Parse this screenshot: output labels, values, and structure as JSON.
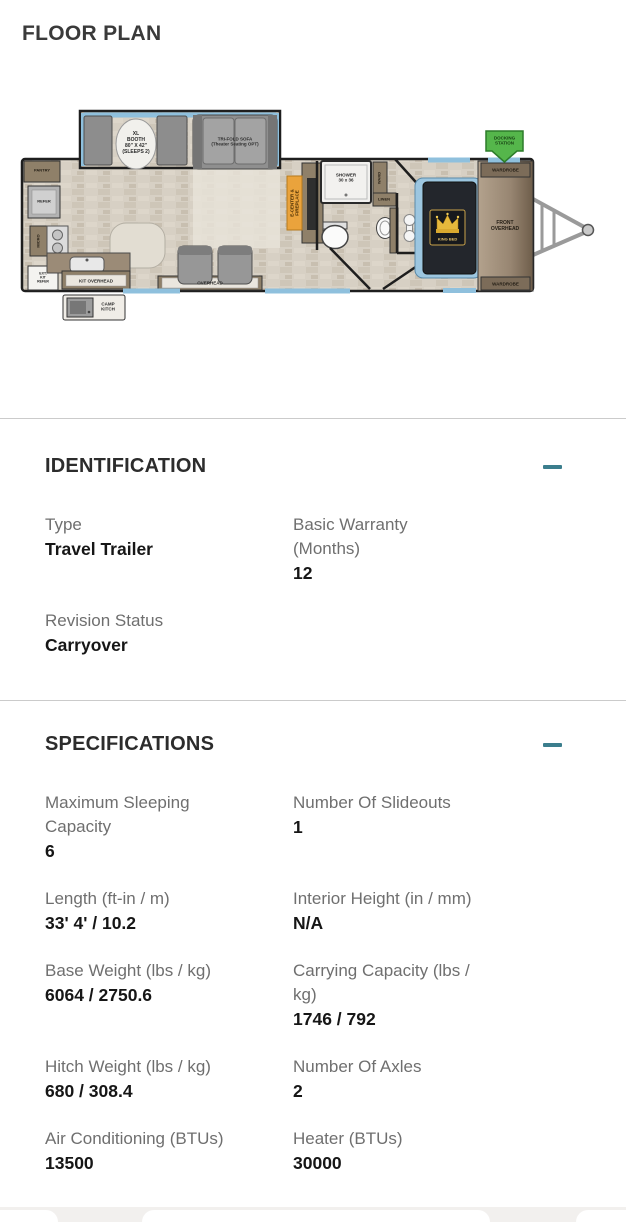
{
  "page": {
    "title": "FLOOR PLAN"
  },
  "theme": {
    "accent_teal": "#3B7E8D",
    "divider_gray": "#CBCBCB",
    "label_gray": "#6F6F6F",
    "value_dark": "#161616",
    "heading_dark": "#2C2C2C",
    "floor_tan": "#D7D0C4",
    "cabinet_brown": "#8F8069",
    "window_blue": "#8FC0DD",
    "docking_green": "#55B64B",
    "ecenter_orange": "#EAA33C"
  },
  "floor_plan": {
    "labels": {
      "xl_booth": "XL\nBOOTH\n80\" X 42\"\n(SLEEPS 2)",
      "tri_fold_sofa": "TRI-FOLD SOFA\n(Theater Seating OPT)",
      "pantry": "PANTRY",
      "refer": "REFER",
      "micro": "MICRO",
      "ext_kit": "EXT.\nKIT\nREFER",
      "kit_overhead": "KIT OVERHEAD",
      "overhead": "OVERHEAD",
      "camp_kitch": "CAMP\nKITCH",
      "e_center": "E-CENTER &\nFIREPLACE",
      "shower": "SHOWER\n30 x 36",
      "ward": "WARD",
      "linen": "LINEN",
      "king_bed": "KING BED",
      "front_overhead": "FRONT\nOVERHEAD",
      "wardrobe_top": "WARDROBE",
      "wardrobe_bottom": "WARDROBE",
      "docking_station": "DOCKING\nSTATION"
    }
  },
  "identification": {
    "heading": "IDENTIFICATION",
    "fields": [
      {
        "label": "Type",
        "value": "Travel Trailer"
      },
      {
        "label": "Basic Warranty\n(Months)",
        "value": "12"
      },
      {
        "label": "Revision Status",
        "value": "Carryover"
      }
    ]
  },
  "specifications": {
    "heading": "SPECIFICATIONS",
    "fields": [
      {
        "label": "Maximum Sleeping\nCapacity",
        "value": "6"
      },
      {
        "label": "Number Of Slideouts",
        "value": "1"
      },
      {
        "label": "Length (ft-in / m)",
        "value": "33' 4' / 10.2"
      },
      {
        "label": "Interior Height (in / mm)",
        "value": "N/A"
      },
      {
        "label": "Base Weight (lbs / kg)",
        "value": "6064 / 2750.6"
      },
      {
        "label": "Carrying Capacity (lbs /\nkg)",
        "value": "1746 / 792"
      },
      {
        "label": "Hitch Weight (lbs / kg)",
        "value": "680 / 308.4"
      },
      {
        "label": "Number Of Axles",
        "value": "2"
      },
      {
        "label": "Air Conditioning (BTUs)",
        "value": "13500"
      },
      {
        "label": "Heater (BTUs)",
        "value": "30000"
      }
    ]
  }
}
